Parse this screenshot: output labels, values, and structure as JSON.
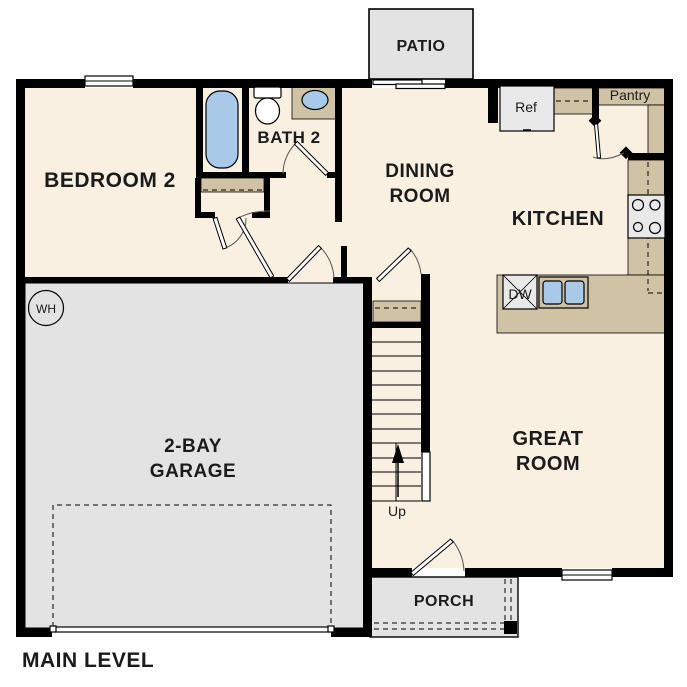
{
  "title": "MAIN LEVEL",
  "rooms": {
    "bedroom2": {
      "label": "BEDROOM 2"
    },
    "bath2": {
      "label": "BATH 2"
    },
    "dining": {
      "label_line1": "DINING",
      "label_line2": "ROOM"
    },
    "kitchen": {
      "label": "KITCHEN"
    },
    "great_room": {
      "label_line1": "GREAT",
      "label_line2": "ROOM"
    },
    "garage": {
      "label_line1": "2-BAY",
      "label_line2": "GARAGE"
    },
    "patio": {
      "label": "PATIO"
    },
    "porch": {
      "label": "PORCH"
    },
    "pantry": {
      "label": "Pantry"
    }
  },
  "fixtures": {
    "refrigerator": "Ref",
    "dishwasher": "DW",
    "water_heater": "WH",
    "stairs_direction": "Up"
  },
  "colors": {
    "floor": "#f9f0e2",
    "hard-surface": "#e3e3e3",
    "counter": "#d0c2a4",
    "fixture-blue": "#a9c9e9",
    "appliance": "#e9e9e9",
    "wall": "#000000"
  }
}
